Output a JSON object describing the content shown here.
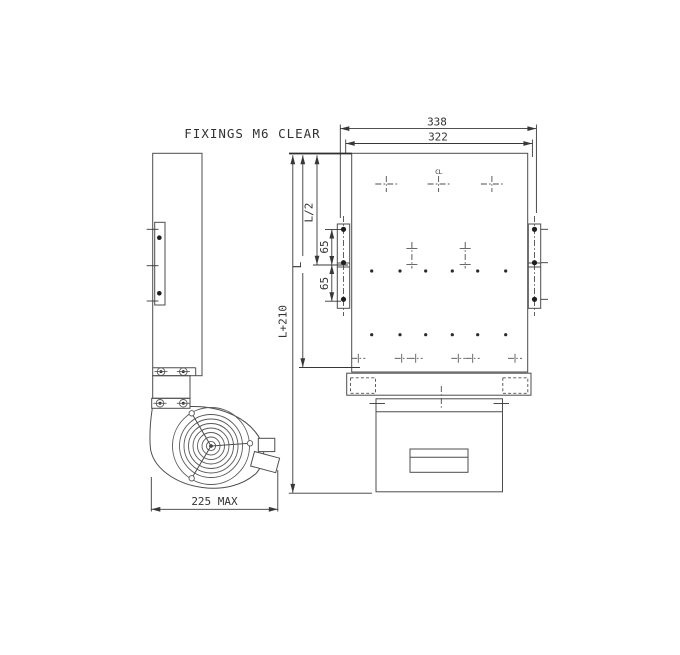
{
  "drawing": {
    "title": "FIXINGS M6 CLEAR",
    "centerline_symbol": "CL",
    "dimensions": {
      "overall_width": "338",
      "fixing_width": "322",
      "half_length": "L/2",
      "hole_pitch_upper": "65",
      "hole_pitch_lower": "65",
      "length": "L",
      "overall_length": "L+210",
      "depth_max": "225 MAX"
    },
    "colors": {
      "line": "#4d4d4d",
      "dimension": "#383838",
      "background": "#ffffff"
    }
  }
}
